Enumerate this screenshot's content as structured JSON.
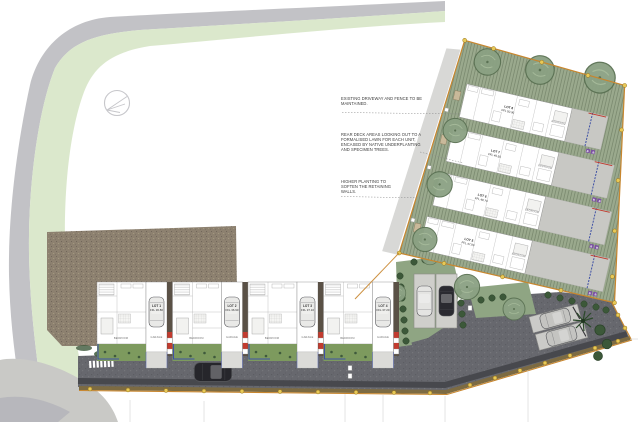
{
  "drawing": {
    "kind": "residential development site plan",
    "annotations": {
      "note1": {
        "lines": [
          "EXISTING DRIVEWAY AND FENCE TO BE",
          "MAINTAINED."
        ]
      },
      "note2": {
        "lines": [
          "REAR DECK AREAS LOOKING OUT TO A",
          "FORMALISED LAWN FOR EACH UNIT,",
          "ENCASED BY NATIVE UNDERPLANTING",
          "AND SPECIMEN TREES."
        ]
      },
      "note3": {
        "lines": [
          "HIGHER PLANTING TO",
          "SOFTEN THE RETAINING",
          "WALLS."
        ]
      }
    },
    "rooms": {
      "bedroom": "BEDROOM",
      "garage": "GARAGE"
    },
    "lots": {
      "bottom_row": [
        {
          "lot": "LOT 1",
          "ffl": "FFL 36.80"
        },
        {
          "lot": "LOT 2",
          "ffl": "FFL 36.90"
        },
        {
          "lot": "LOT 3",
          "ffl": "FFL 37.10"
        },
        {
          "lot": "LOT 4",
          "ffl": "FFL 37.20"
        }
      ],
      "upper_block": [
        {
          "lot": "LOT 8",
          "ffl": "FFL 50.30"
        },
        {
          "lot": "LOT 7",
          "ffl": "FFL 49.50"
        },
        {
          "lot": "LOT 6",
          "ffl": "FFL 48.70"
        },
        {
          "lot": "LOT 5",
          "ffl": "FFL 47.90"
        }
      ]
    },
    "markers": {
      "b_label": "B B"
    },
    "icons": {
      "north_arrow": "circle-arrow-compass",
      "tree": "canopy-circle",
      "shrub": "dark-bush-dot",
      "palm": "palm-star",
      "car": "car-top-view",
      "street_light": "yellow-dot",
      "sign": "white-square-marker"
    },
    "colors": {
      "road_gray": "#b5b5ba",
      "verge_green": "#d8e6c8",
      "ground_brown": "#8d8170",
      "asphalt": "#67686e",
      "kerb_olive": "#7d6b42",
      "boundary_orange": "#c8862e",
      "light_yellow": "#e8c957",
      "lawn_sage": "#9aa98d",
      "lawn_bright": "#7d9a5e",
      "tree_green": "#8ba183",
      "shrub_dark": "#3c5839",
      "deck_blue": "#3f51a5",
      "accent_red": "#c23b2f",
      "marker_purple": "#7b4fa3",
      "separator_brown": "#5a5146",
      "car_dark": "#26262b"
    }
  }
}
